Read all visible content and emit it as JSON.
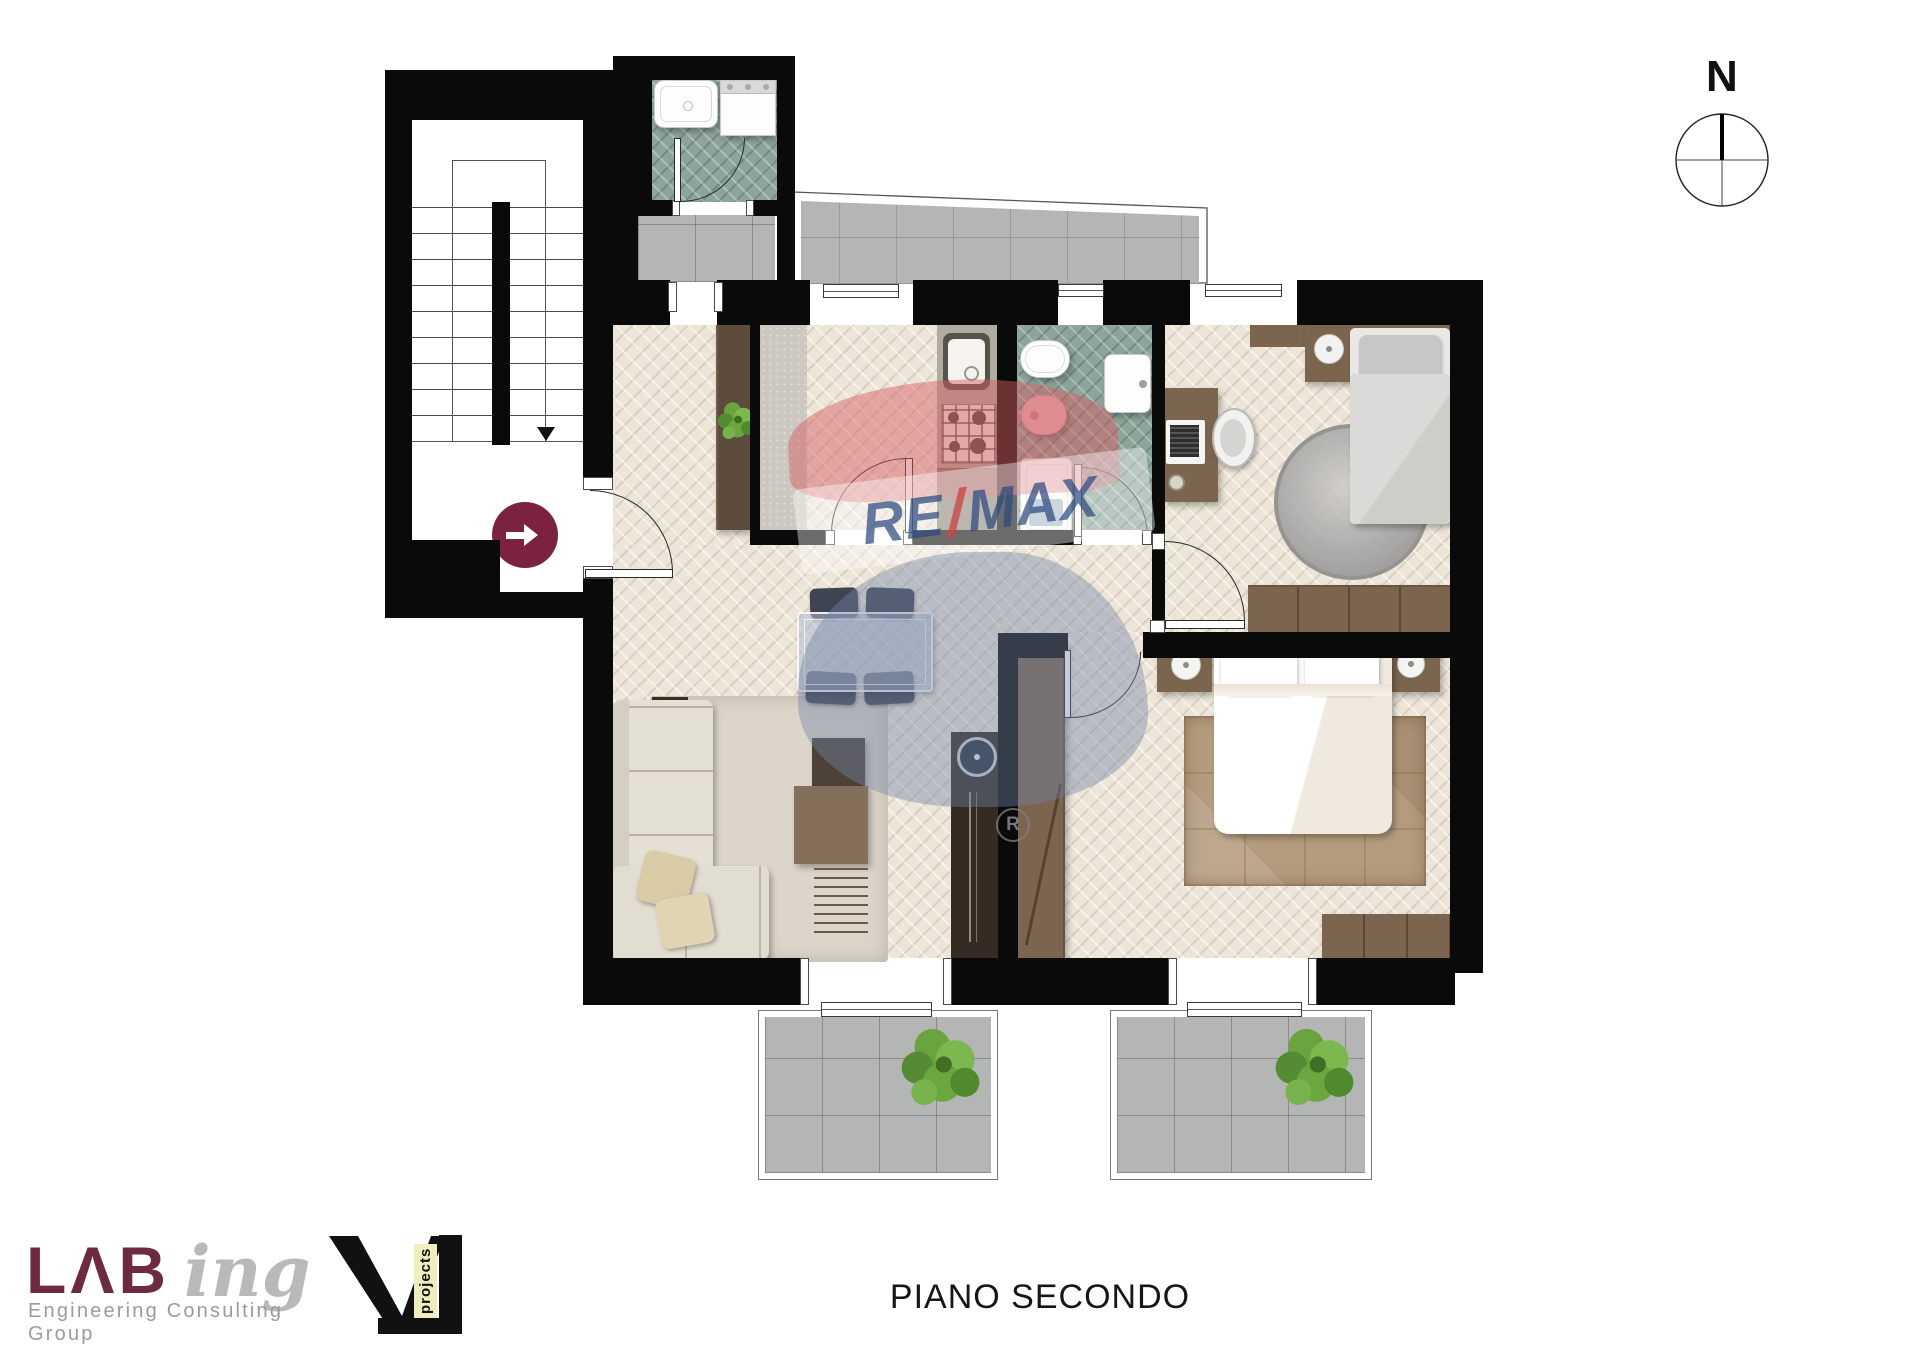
{
  "title": {
    "text": "PIANO SECONDO"
  },
  "compass": {
    "label": "N"
  },
  "watermark": {
    "re": "RE",
    "slash": "/",
    "max": "MAX",
    "registered": "R"
  },
  "logos": {
    "labing": {
      "display_bold": "LΛB",
      "display_script": "ing",
      "tagline": "Engineering Consulting Group"
    },
    "vl": {
      "vertical_text": "projects"
    }
  },
  "palette": {
    "wall": "#0a0a0a",
    "wood_floor": "#ece5d8",
    "teal_floor": "#8da49b",
    "tile_gray": "#b3b6b4",
    "kitchen_strip": "#ccc8bf",
    "wood_dark": "#3a2f26",
    "wood_mid": "#7b654e",
    "entrance_marker_maroon": "#7d2140",
    "remax_red": "#d65e62",
    "remax_blue": "#2b4a80",
    "labing_maroon": "#6e2a3e",
    "labing_gray": "#b9b9b9",
    "vl_yellow": "#f2edbe"
  }
}
